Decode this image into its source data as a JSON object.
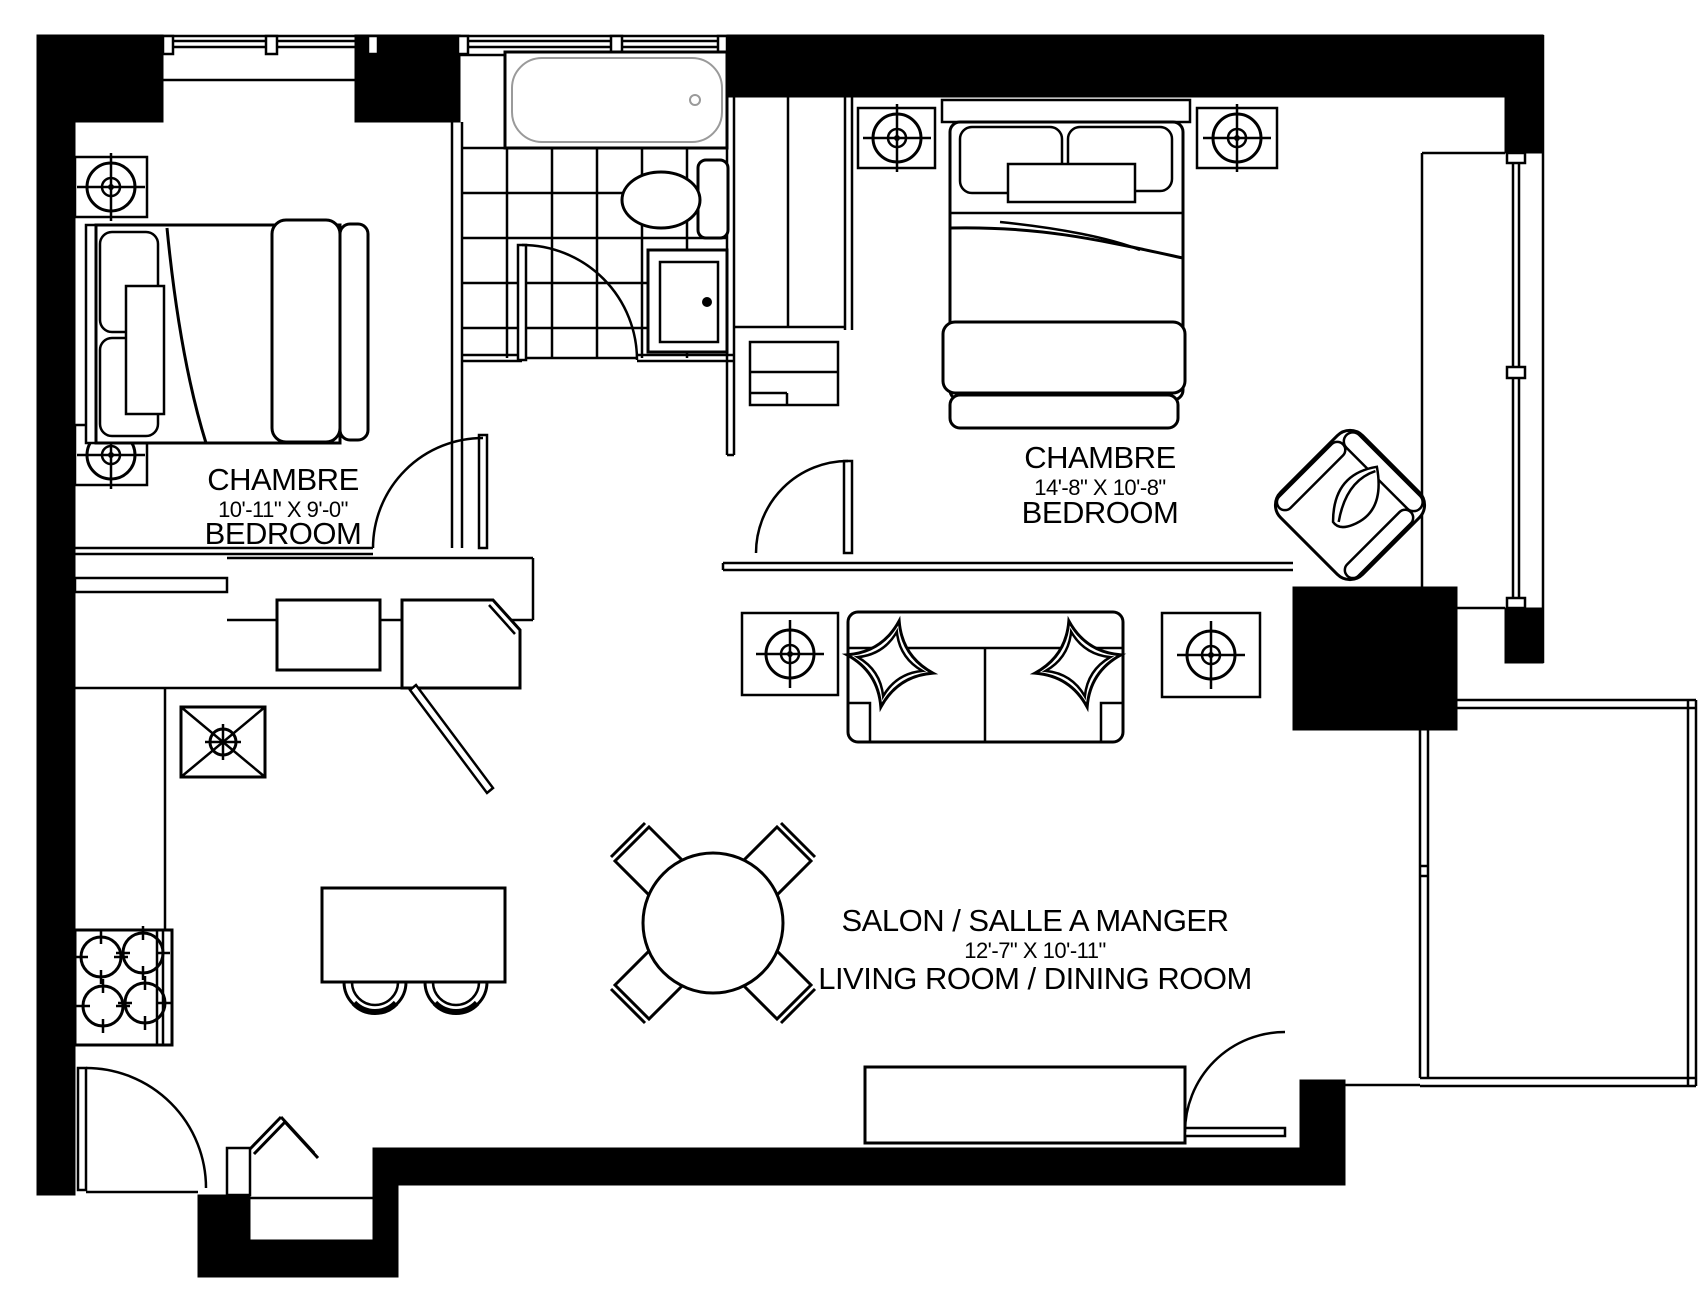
{
  "floor_plan": {
    "title": "apartment-floor-plan",
    "rooms": [
      {
        "id": "bedroom-left",
        "name_fr": "CHAMBRE",
        "dimensions": "10'-11\" X 9'-0\"",
        "name_en": "BEDROOM"
      },
      {
        "id": "bedroom-right",
        "name_fr": "CHAMBRE",
        "dimensions": "14'-8\" X 10'-8\"",
        "name_en": "BEDROOM"
      },
      {
        "id": "living-dining",
        "name_fr": "SALON / SALLE A MANGER",
        "dimensions": "12'-7\" X 10'-11\"",
        "name_en": "LIVING ROOM  / DINING ROOM"
      }
    ],
    "colors": {
      "wall": "#000000",
      "floor": "#ffffff",
      "lines": "#000000",
      "tub_outline": "#9a9a9a"
    },
    "furniture_icons": [
      "double-bed",
      "pillow",
      "nightstand",
      "table-lamp",
      "bathtub",
      "toilet",
      "vanity-cabinet",
      "wardrobe-closet",
      "dresser",
      "sofa",
      "cushion",
      "armchair",
      "dining-table",
      "dining-chair",
      "kitchen-island",
      "bar-stool",
      "stove-burners",
      "ceiling-light",
      "dishwasher",
      "corner-cabinet",
      "tv-bench",
      "door-swing",
      "window",
      "balcony-railing"
    ]
  }
}
